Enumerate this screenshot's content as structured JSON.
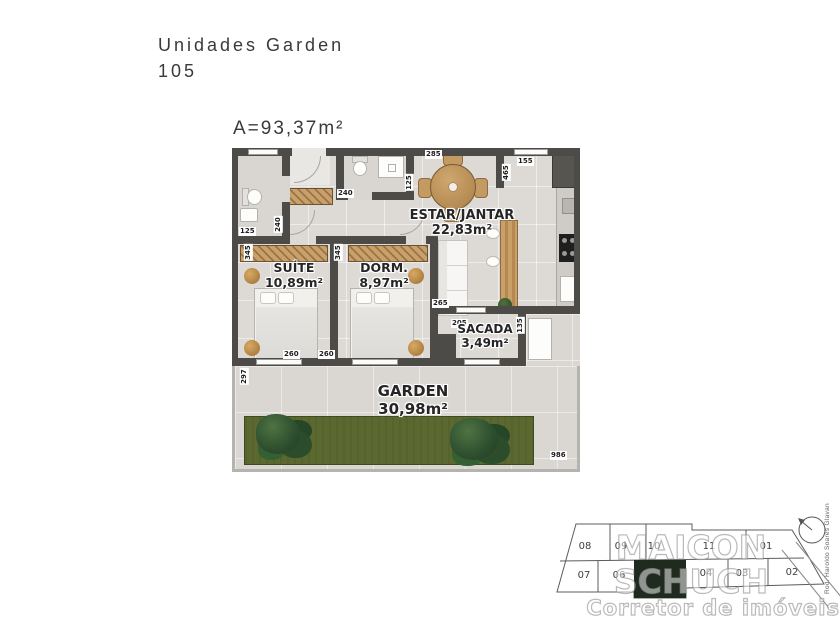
{
  "header": {
    "title_line1": "Unidades Garden",
    "title_line2": "105",
    "area": "A=93,37m²"
  },
  "plan": {
    "rooms": {
      "estar": {
        "name": "ESTAR/JANTAR",
        "area": "22,83m²"
      },
      "suite": {
        "name": "SUÍTE",
        "area": "10,89m²"
      },
      "dorm": {
        "name": "DORM.",
        "area": "8,97m²"
      },
      "sacada": {
        "name": "SACADA",
        "area": "3,49m²"
      },
      "garden": {
        "name": "GARDEN",
        "area": "30,98m²"
      }
    },
    "dims": [
      "285",
      "465",
      "155",
      "240",
      "125",
      "125",
      "240",
      "345",
      "345",
      "265",
      "205",
      "135",
      "260",
      "260",
      "297",
      "986"
    ]
  },
  "keyplan": {
    "units_top": [
      "08",
      "09",
      "10",
      "11",
      "01"
    ],
    "units_bottom": [
      "07",
      "06",
      "",
      "04",
      "03",
      "02"
    ],
    "highlighted_unit_index": 2,
    "highlight_color": "#202b1f",
    "road_label": "Rod. Haroldo Soares Glavan"
  },
  "watermark": {
    "line1": "MAICON SCHUCH",
    "line2": "Corretor de imóveis"
  },
  "colors": {
    "wall": "#4d4b48",
    "floor": "#ddd9d4",
    "grass": "#5b6930",
    "wood": "#c49a63",
    "highlight": "#202b1f"
  }
}
